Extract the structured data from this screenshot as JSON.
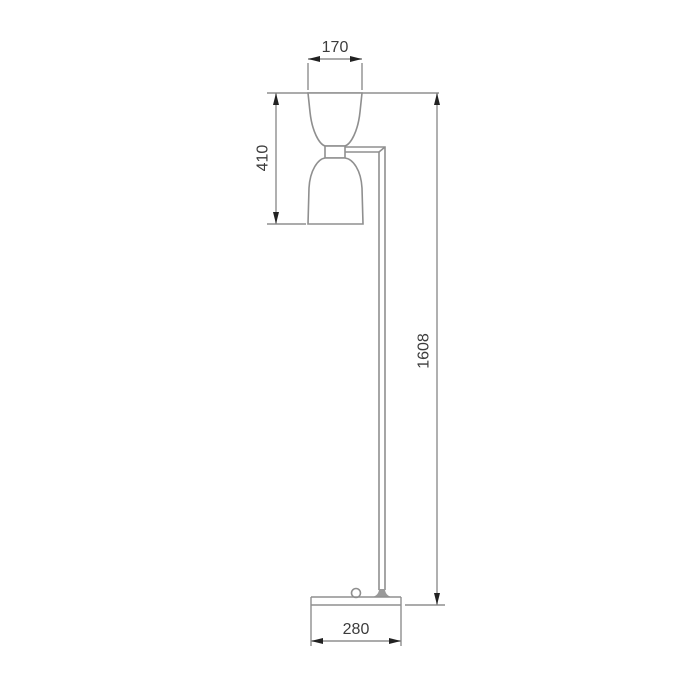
{
  "drawing": {
    "colors": {
      "bg": "#ffffff",
      "line": "#8f8f8f",
      "arrow": "#222222",
      "text": "#3c3c3c"
    },
    "dimensions": {
      "top_shade_width": {
        "label": "170",
        "orientation": "horizontal"
      },
      "shade_assembly_height": {
        "label": "410",
        "orientation": "vertical"
      },
      "total_height": {
        "label": "1608",
        "orientation": "vertical"
      },
      "base_width": {
        "label": "280",
        "orientation": "horizontal"
      }
    }
  }
}
